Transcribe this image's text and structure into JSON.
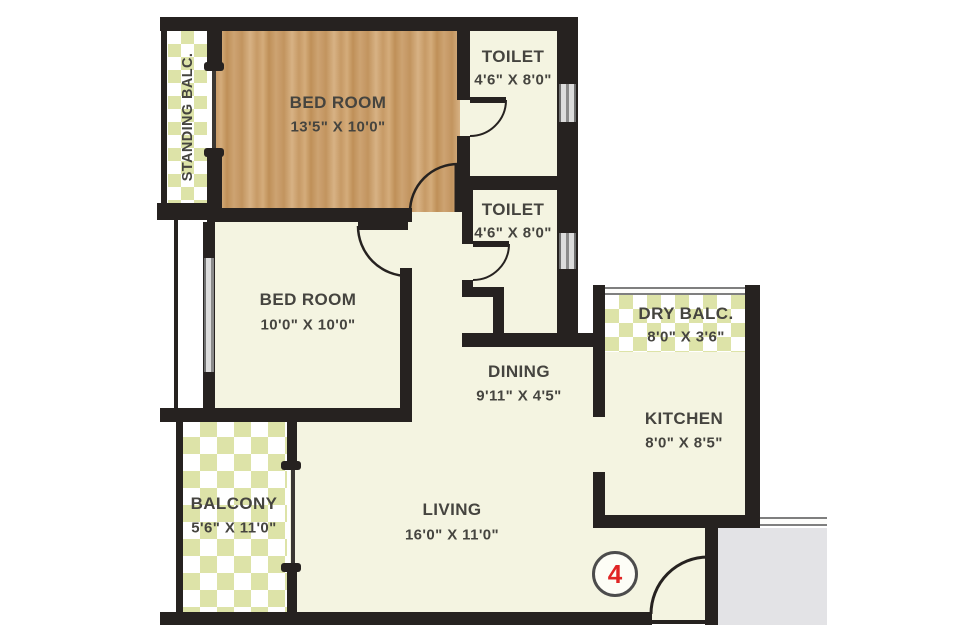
{
  "plan_title": "Residential Unit Floor Plan",
  "unit_marker": {
    "number": "4"
  },
  "rooms": {
    "standing_balc": {
      "name": "STANDING BALC.",
      "dims": ""
    },
    "bedroom1": {
      "name": "BED ROOM",
      "dims": "13'5\" X 10'0\""
    },
    "toilet1": {
      "name": "TOILET",
      "dims": "4'6\" X 8'0\""
    },
    "toilet2": {
      "name": "TOILET",
      "dims": "4'6\" X 8'0\""
    },
    "bedroom2": {
      "name": "BED ROOM",
      "dims": "10'0\" X 10'0\""
    },
    "dining": {
      "name": "DINING",
      "dims": "9'11\" X 4'5\""
    },
    "dry_balc": {
      "name": "DRY BALC.",
      "dims": "8'0\" X 3'6\""
    },
    "kitchen": {
      "name": "KITCHEN",
      "dims": "8'0\" X 8'5\""
    },
    "balcony": {
      "name": "BALCONY",
      "dims": "5'6\" X 11'0\""
    },
    "living": {
      "name": "LIVING",
      "dims": "16'0\" X 11'0\""
    }
  },
  "colors": {
    "wall": "#262220",
    "floor_cream": "#f4f4e1",
    "checker_green": "#dde3a8",
    "wood": "#c79a66",
    "label_text": "#45443f",
    "unit_red": "#e02525",
    "corridor_gray": "#e3e3e6"
  }
}
